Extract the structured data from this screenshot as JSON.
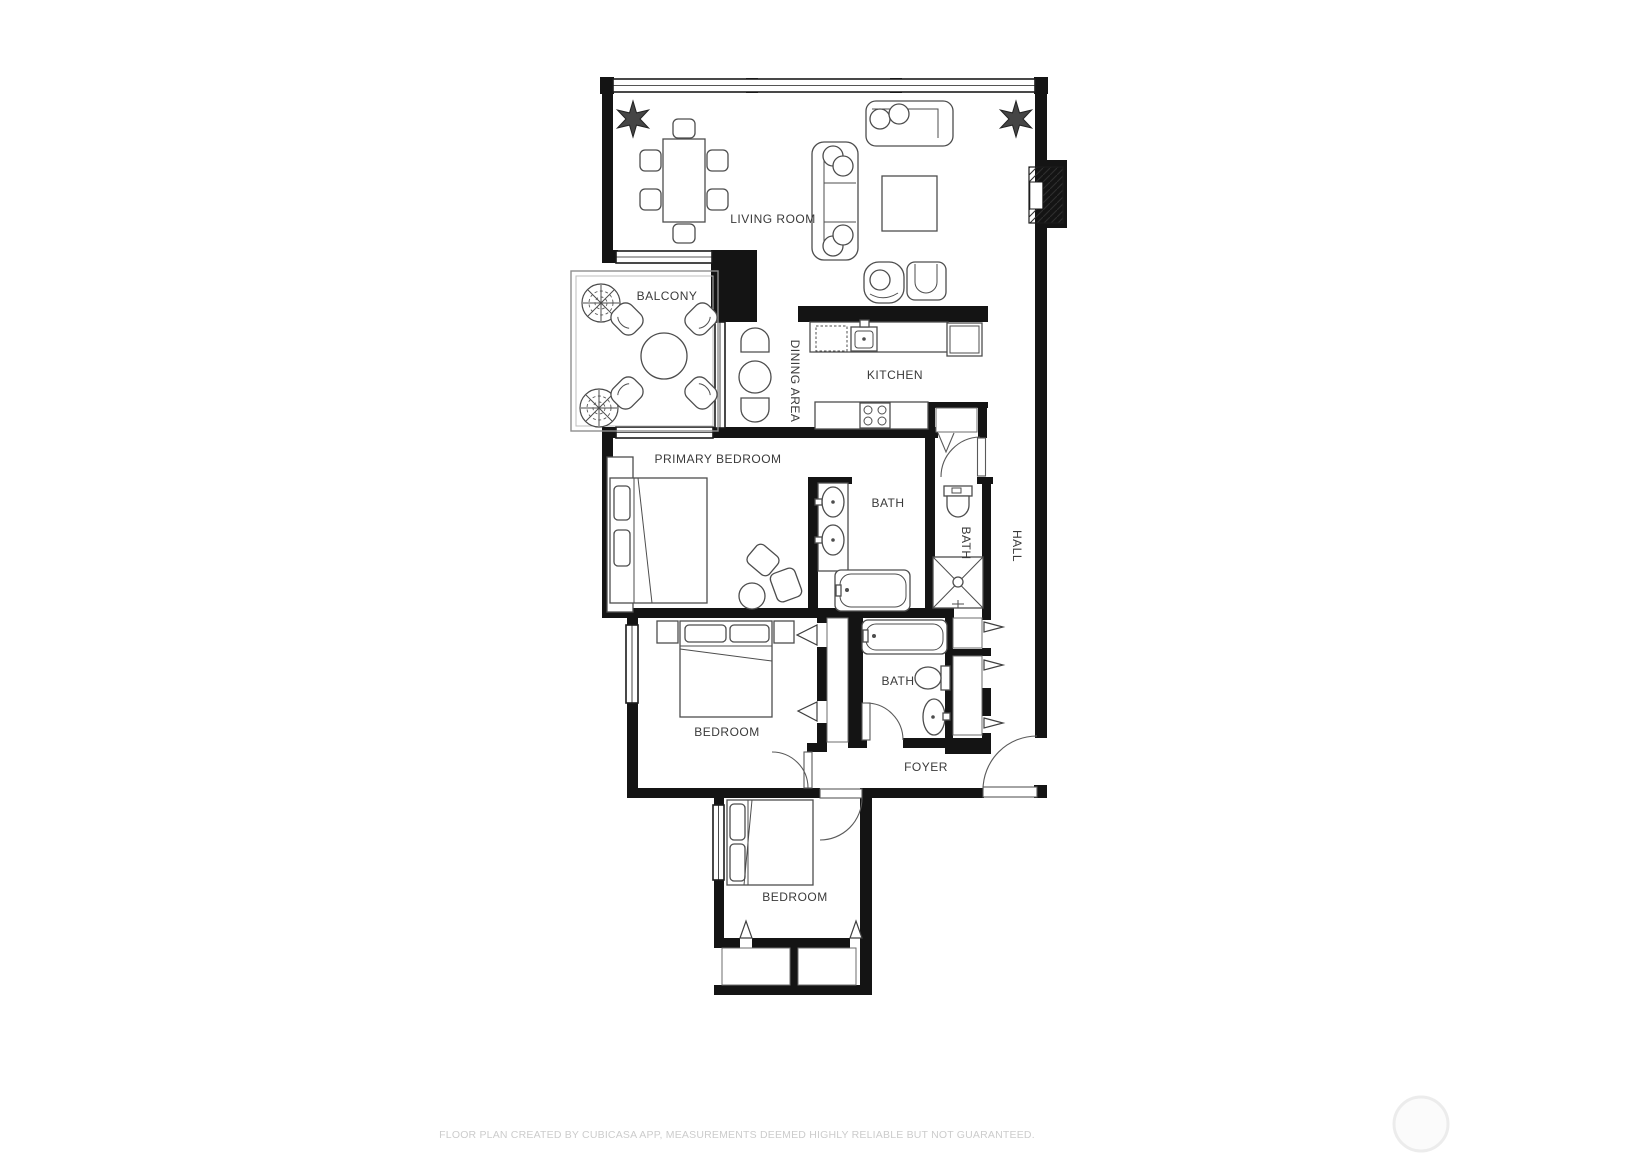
{
  "page": {
    "background": "#ffffff",
    "type": "floor-plan"
  },
  "rooms": {
    "living_room": {
      "label": "LIVING ROOM"
    },
    "balcony": {
      "label": "BALCONY"
    },
    "dining_area": {
      "label": "DINING AREA"
    },
    "kitchen": {
      "label": "KITCHEN"
    },
    "primary_bedroom": {
      "label": "PRIMARY BEDROOM"
    },
    "bath_main": {
      "label": "BATH"
    },
    "bath_small": {
      "label": "BATH"
    },
    "hall": {
      "label": "HALL"
    },
    "bedroom_middle": {
      "label": "BEDROOM"
    },
    "bath_lower": {
      "label": "BATH"
    },
    "foyer": {
      "label": "FOYER"
    },
    "bedroom_lower": {
      "label": "BEDROOM"
    }
  },
  "footer": {
    "disclaimer": "FLOOR PLAN CREATED BY CUBICASA APP, MEASUREMENTS DEEMED HIGHLY RELIABLE BUT NOT GUARANTEED."
  },
  "colors": {
    "wall": "#141414",
    "furniture_line": "#4d4d4d",
    "room_label": "#3a3a3a",
    "disclaimer_text": "#cccccc",
    "balcony_rail": "#8f8f8f",
    "watermark_ring": "#ececec"
  }
}
